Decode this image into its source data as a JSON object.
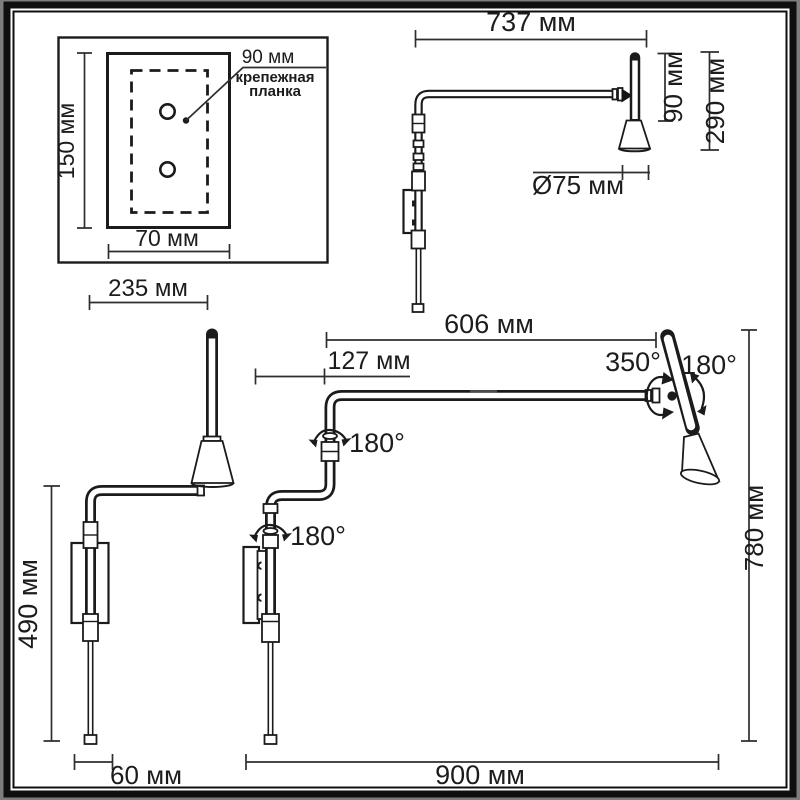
{
  "drawing": {
    "mounting_plate": {
      "hole_spacing": "90 мм",
      "label_line1": "крепежная",
      "label_line2": "планка",
      "height": "150 мм",
      "width": "70 мм"
    },
    "side_view": {
      "arm_length": "737 мм",
      "head_stem_height": "90 мм",
      "head_total_height": "290 мм",
      "shade_diameter": "Ø75 мм"
    },
    "front_view": {
      "arm_projection": "235 мм",
      "body_height": "490 мм",
      "wall_depth": "60 мм"
    },
    "extended_view": {
      "arm_reach": "606 мм",
      "wall_arm_offset": "127 мм",
      "arm_swivel_angle": "350°",
      "head_tilt_angle": "180°",
      "elbow_swivel_angle": "180°",
      "base_swivel_angle": "180°",
      "max_width": "900 мм",
      "max_height": "780 мм"
    }
  }
}
